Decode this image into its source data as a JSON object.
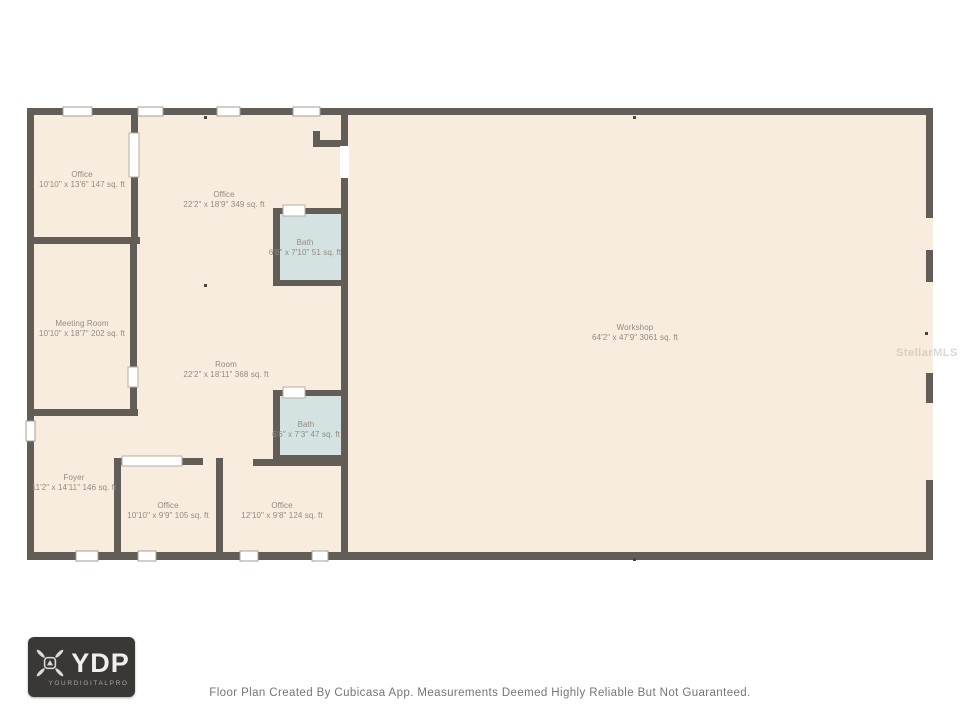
{
  "floor_plan": {
    "rooms": [
      {
        "name": "Office",
        "size": "10'10\" x 13'6\" 147 sq. ft"
      },
      {
        "name": "Office",
        "size": "22'2\" x 18'9\" 349 sq. ft"
      },
      {
        "name": "Bath",
        "size": "6'6\" x 7'10\" 51 sq. ft"
      },
      {
        "name": "Meeting Room",
        "size": "10'10\" x 18'7\" 202 sq. ft"
      },
      {
        "name": "Room",
        "size": "22'2\" x 18'11\" 368 sq. ft"
      },
      {
        "name": "Bath",
        "size": "6'6\" x 7'3\" 47 sq. ft"
      },
      {
        "name": "Foyer",
        "size": "11'2\" x 14'11\" 146 sq. ft"
      },
      {
        "name": "Office",
        "size": "10'10\" x 9'9\" 105 sq. ft"
      },
      {
        "name": "Office",
        "size": "12'10\" x 9'8\" 124 sq. ft"
      },
      {
        "name": "Workshop",
        "size": "64'2\" x 47'9\" 3061 sq. ft"
      }
    ],
    "watermark": "StellarMLS",
    "colors": {
      "floor": "#f8ecdf",
      "wall": "#625d56",
      "bath": "#d4e3e2",
      "label": "#918b82"
    }
  },
  "footer": {
    "disclaimer": "Floor Plan Created By Cubicasa App. Measurements Deemed Highly Reliable But Not Guaranteed.",
    "logo": {
      "abbr": "YDP",
      "name": "YOURDIGITALPRO",
      "icon": "drone-icon"
    }
  }
}
